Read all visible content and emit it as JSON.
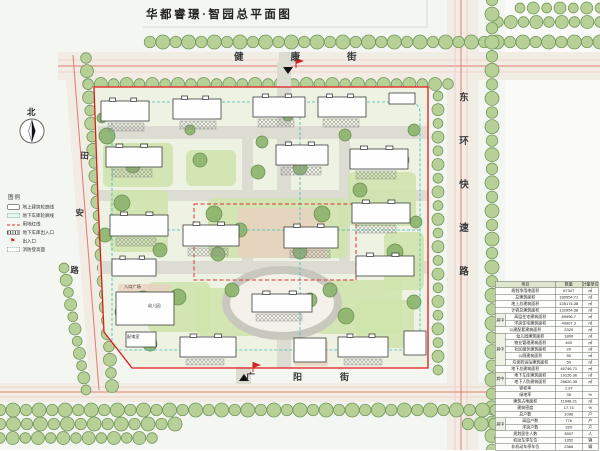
{
  "title": "华都睿璟·智园总平面图",
  "streets": {
    "north": "健康街",
    "south": "广阳街",
    "east": "东环快速路",
    "west": "田安路"
  },
  "compass": {
    "label": "北"
  },
  "legend": {
    "title": "图例",
    "items": [
      {
        "symbol": "building",
        "label": "地上建筑轮廓线"
      },
      {
        "symbol": "garage",
        "label": "地下车库轮廓线"
      },
      {
        "symbol": "redline",
        "label": "用地红线"
      },
      {
        "symbol": "ramp",
        "label": "地下车库出入口"
      },
      {
        "symbol": "flag",
        "label": "出入口"
      },
      {
        "symbol": "fire",
        "label": "消防登高面"
      }
    ]
  },
  "table": {
    "headers": [
      "项目",
      "数量",
      "计量单位"
    ],
    "rows": [
      {
        "item": "规划净用地面积",
        "value": "67347",
        "unit": "㎡"
      },
      {
        "item": "总建筑面积",
        "value": "180954.71",
        "unit": "㎡"
      },
      {
        "item": "地上总建筑面积",
        "value": "135174.38",
        "unit": "㎡"
      },
      {
        "item": "计容总建筑面积",
        "value": "132954.38",
        "unit": "㎡"
      },
      {
        "group": "其中",
        "span": 2,
        "item": "高层住宅建筑面积",
        "value": "89996.7",
        "unit": "㎡"
      },
      {
        "in": true,
        "item": "洋房住宅建筑面积",
        "value": "40967.3",
        "unit": "㎡"
      },
      {
        "item": "公建配套建筑面积",
        "value": "2320",
        "unit": "㎡"
      },
      {
        "group": "其中",
        "span": 5,
        "item": "幼儿园建筑面积",
        "value": "1800",
        "unit": "㎡"
      },
      {
        "in": true,
        "item": "物业管理建筑面积",
        "value": "400",
        "unit": "㎡"
      },
      {
        "in": true,
        "item": "社区服务建筑面积",
        "value": "20",
        "unit": "㎡"
      },
      {
        "in": true,
        "item": "公厕建筑面积",
        "value": "50",
        "unit": "㎡"
      },
      {
        "in": true,
        "item": "垃圾转运站建筑面积",
        "value": "50",
        "unit": "㎡"
      },
      {
        "item": "地下总建筑面积",
        "value": "45746.71",
        "unit": "㎡"
      },
      {
        "group": "其中",
        "span": 2,
        "item": "地下车库建筑面积",
        "value": "19126.36",
        "unit": "㎡"
      },
      {
        "in": true,
        "item": "地下人防建筑面积",
        "value": "26620.35",
        "unit": "㎡"
      },
      {
        "item": "容积率",
        "value": "1.97",
        "unit": ""
      },
      {
        "item": "绿地率",
        "value": "35",
        "unit": "%"
      },
      {
        "item": "建筑占地面积",
        "value": "11948.21",
        "unit": "㎡"
      },
      {
        "item": "建筑密度",
        "value": "17.74",
        "unit": "%"
      },
      {
        "item": "总户数",
        "value": "1096",
        "unit": "户"
      },
      {
        "group": "其中",
        "span": 2,
        "item": "高层户数",
        "value": "776",
        "unit": "户"
      },
      {
        "in": true,
        "item": "洋房户数",
        "value": "320",
        "unit": "户"
      },
      {
        "item": "规划居住人数",
        "value": "3507",
        "unit": "人"
      },
      {
        "item": "机动车停车位",
        "value": "1352",
        "unit": "辆"
      },
      {
        "item": "非机动车停车位",
        "value": "2366",
        "unit": "辆"
      }
    ]
  },
  "plan": {
    "labels": [
      {
        "t": "入口广场",
        "x": 124,
        "y": 284
      },
      {
        "t": "幼儿园",
        "x": 148,
        "y": 303
      },
      {
        "t": "配电室",
        "x": 127,
        "y": 334
      }
    ],
    "tree_rows": [
      [
        150,
        42,
        600,
        42,
        13,
        7
      ],
      [
        520,
        8,
        600,
        8,
        13,
        6
      ],
      [
        498,
        22,
        600,
        22,
        13,
        6.5
      ],
      [
        88,
        84,
        448,
        84,
        13,
        6.5
      ],
      [
        492,
        0,
        492,
        450,
        14,
        7
      ],
      [
        438,
        96,
        438,
        370,
        14,
        6
      ],
      [
        86,
        58,
        112,
        386,
        13,
        6.5
      ],
      [
        64,
        268,
        86,
        390,
        13,
        6
      ],
      [
        0,
        410,
        600,
        410,
        13,
        7
      ],
      [
        0,
        424,
        175,
        424,
        13,
        7
      ],
      [
        468,
        424,
        600,
        424,
        13,
        7
      ],
      [
        0,
        438,
        152,
        438,
        13,
        6.5
      ],
      [
        500,
        438,
        600,
        438,
        13,
        6.5
      ]
    ],
    "trees": [
      [
        107,
        136,
        8
      ],
      [
        133,
        166,
        7
      ],
      [
        122,
        203,
        8
      ],
      [
        105,
        235,
        7
      ],
      [
        143,
        300,
        9
      ],
      [
        122,
        312,
        7
      ],
      [
        160,
        250,
        7
      ],
      [
        178,
        297,
        8
      ],
      [
        150,
        344,
        7
      ],
      [
        205,
        344,
        6
      ],
      [
        200,
        160,
        7
      ],
      [
        258,
        172,
        7
      ],
      [
        300,
        168,
        7
      ],
      [
        214,
        214,
        8
      ],
      [
        240,
        230,
        7
      ],
      [
        322,
        214,
        8
      ],
      [
        300,
        252,
        7
      ],
      [
        218,
        254,
        7
      ],
      [
        262,
        142,
        6
      ],
      [
        345,
        135,
        6
      ],
      [
        360,
        190,
        7
      ],
      [
        395,
        252,
        8
      ],
      [
        402,
        160,
        7
      ],
      [
        414,
        130,
        6
      ],
      [
        330,
        290,
        7
      ],
      [
        232,
        290,
        7
      ],
      [
        346,
        316,
        8
      ],
      [
        372,
        350,
        7
      ],
      [
        310,
        300,
        7
      ],
      [
        416,
        222,
        6
      ],
      [
        414,
        302,
        7
      ],
      [
        288,
        116,
        5
      ],
      [
        190,
        130,
        5
      ],
      [
        102,
        118,
        5
      ]
    ],
    "green": [
      [
        103,
        143,
        70,
        44
      ],
      [
        186,
        150,
        50,
        36
      ],
      [
        208,
        198,
        140,
        60
      ],
      [
        110,
        190,
        58,
        62
      ],
      [
        348,
        172,
        68,
        54
      ],
      [
        384,
        232,
        40,
        58
      ],
      [
        148,
        282,
        62,
        50
      ],
      [
        316,
        280,
        86,
        54
      ],
      [
        196,
        288,
        64,
        48
      ],
      [
        356,
        300,
        58,
        48
      ]
    ],
    "paving": [
      [
        238,
        208,
        88,
        50
      ],
      [
        294,
        340,
        34,
        26
      ],
      [
        118,
        284,
        52,
        12
      ]
    ],
    "roads": [
      [
        98,
        126,
        330,
        13
      ],
      [
        98,
        190,
        330,
        11
      ],
      [
        98,
        261,
        330,
        13
      ],
      [
        277,
        62,
        14,
        146
      ],
      [
        242,
        139,
        11,
        124
      ],
      [
        339,
        139,
        11,
        124
      ],
      [
        277,
        336,
        14,
        32
      ],
      [
        236,
        367,
        15,
        17
      ],
      [
        279,
        52,
        18,
        12
      ]
    ],
    "hatches": [
      [
        108,
        123,
        36,
        8
      ],
      [
        180,
        121,
        36,
        8
      ],
      [
        258,
        119,
        36,
        8
      ],
      [
        323,
        119,
        36,
        8
      ],
      [
        112,
        169,
        40,
        8
      ],
      [
        281,
        167,
        40,
        8
      ],
      [
        356,
        171,
        40,
        8
      ],
      [
        116,
        238,
        40,
        8
      ],
      [
        188,
        248,
        40,
        8
      ],
      [
        290,
        250,
        40,
        8
      ],
      [
        356,
        225,
        40,
        8
      ],
      [
        256,
        314,
        46,
        7
      ],
      [
        186,
        359,
        38,
        6
      ],
      [
        344,
        359,
        38,
        6
      ]
    ],
    "buildings": [
      [
        101,
        101,
        48,
        20
      ],
      [
        173,
        99,
        48,
        20
      ],
      [
        253,
        97,
        52,
        20
      ],
      [
        318,
        97,
        48,
        20
      ],
      [
        389,
        93,
        26,
        11
      ],
      [
        106,
        147,
        56,
        20
      ],
      [
        276,
        145,
        52,
        20
      ],
      [
        350,
        149,
        58,
        20
      ],
      [
        110,
        215,
        58,
        21
      ],
      [
        112,
        259,
        44,
        17
      ],
      [
        183,
        225,
        56,
        21
      ],
      [
        284,
        227,
        54,
        21
      ],
      [
        352,
        203,
        58,
        20
      ],
      [
        356,
        256,
        58,
        20
      ],
      [
        252,
        294,
        60,
        18
      ],
      [
        180,
        337,
        56,
        20
      ],
      [
        294,
        338,
        32,
        24
      ],
      [
        338,
        337,
        50,
        20
      ],
      [
        404,
        331,
        22,
        24
      ],
      [
        116,
        292,
        58,
        33
      ],
      [
        126,
        332,
        30,
        15
      ]
    ]
  }
}
